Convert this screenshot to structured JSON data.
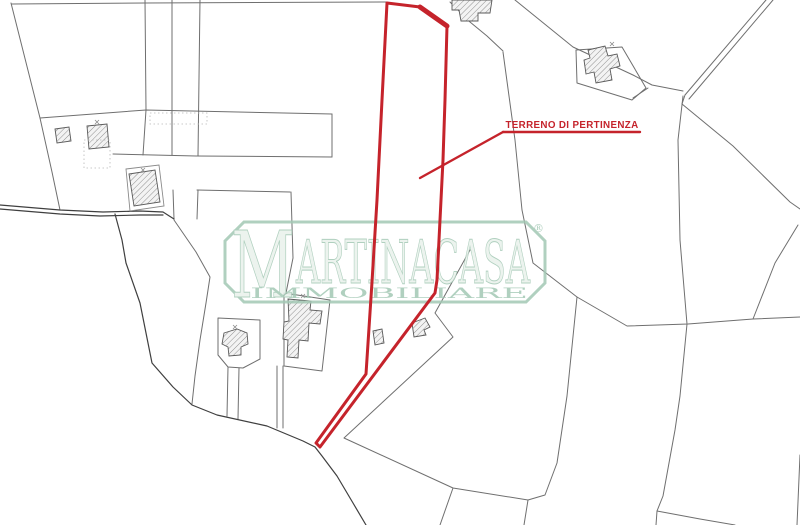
{
  "map": {
    "annotation": {
      "label": "TERRENO DI PERTINENZA"
    },
    "watermark": {
      "initial": "M",
      "name_rest": "ARTINACASA",
      "subtitle": "IMMOBILIARE",
      "registered": "®"
    },
    "colors": {
      "parcel_red": "#c5232b",
      "watermark_green": "#a3c8b4",
      "watermark_fill": "#dfece4",
      "line_gray": "#6f6f6f",
      "road_gray": "#3f3f3f",
      "building_outline": "#5a5a5a"
    }
  }
}
